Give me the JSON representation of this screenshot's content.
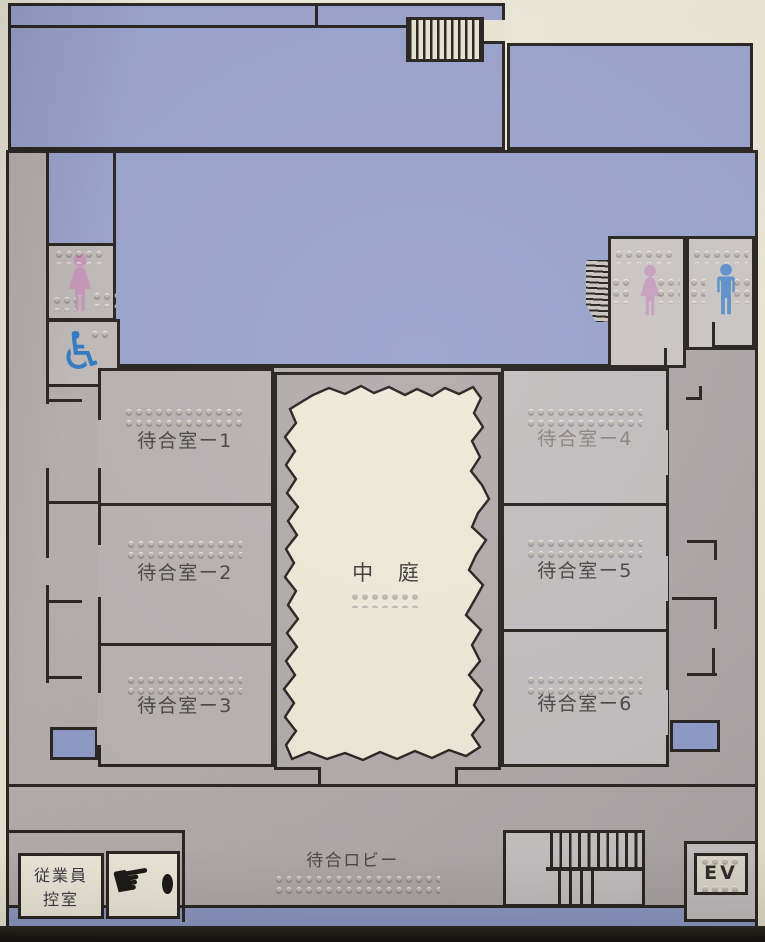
{
  "colors": {
    "cream_background": "#ebe6d4",
    "area_blue": "#9aa3cd",
    "building_grey": "#b1aaab",
    "room_grey_left": "#b9b2b3",
    "room_grey_right": "#c3bebf",
    "bottom_strip_blue": "#8c98c6",
    "outline_black": "#26221f",
    "female_pink": "#c897ba",
    "male_blue": "#5e92cc",
    "wheelchair_blue": "#2e7ac4"
  },
  "rooms": {
    "waiting_room_1": "待合室ー1",
    "waiting_room_2": "待合室ー2",
    "waiting_room_3": "待合室ー3",
    "waiting_room_4": "待合室ー4",
    "waiting_room_5": "待合室ー5",
    "waiting_room_6": "待合室ー6",
    "courtyard": "中 庭",
    "waiting_lobby": "待合ロビー",
    "staff_room_line1": "従業員",
    "staff_room_line2": "控室",
    "elevator": "EV"
  },
  "icons": {
    "wheelchair_glyph": "♿",
    "pointing_hand_glyph": "☛",
    "location_dot_glyph": "●",
    "female_figure": "female-toilet-pictogram",
    "male_figure": "male-toilet-pictogram",
    "stairs_hatching": "stairs-pictogram",
    "braille_dots": "braille-dot-strip"
  }
}
